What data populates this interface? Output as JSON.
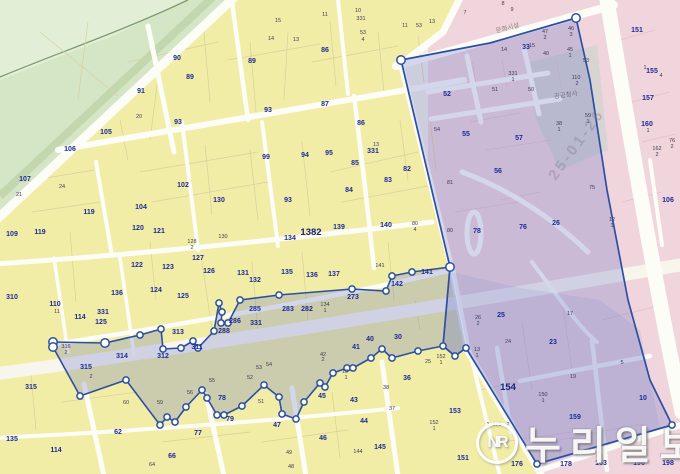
{
  "news_watermark": {
    "logo": "NR",
    "name": "누리일보"
  },
  "date_watermark": "25-01-26",
  "map": {
    "road_label": "문화시설",
    "building_label": "공공청사",
    "colors": {
      "base": "#f2efe6",
      "green": "#d5e6c6",
      "green_light": "#e3eed7",
      "green_band": "#c3d7ae",
      "green_line": "#7d9b70",
      "yellow": "#f1eda7",
      "yellow_line": "#d9cf9b",
      "pink": "#f1d5dc",
      "pink_line": "#e3bfca",
      "grey_block": "#d7d4d2",
      "road": "#fdfdf8",
      "road_major": "#f7f5ec",
      "district_overlay": "rgba(96,108,196,0.26)",
      "district_overlay2": "rgba(110,120,200,0.13)",
      "boundary": "#2b4fa3",
      "vertex_fill": "#ffffff",
      "label_main": "#1c2b96",
      "label_small": "#3d3d55"
    },
    "boundary": {
      "north": [
        [
          53,
          342
        ],
        [
          105,
          343
        ],
        [
          140,
          335
        ],
        [
          161,
          329
        ],
        [
          163,
          349
        ],
        [
          181,
          348
        ],
        [
          193,
          341
        ],
        [
          198,
          348
        ],
        [
          214,
          331
        ],
        [
          219,
          303
        ],
        [
          222,
          312
        ],
        [
          221,
          323
        ],
        [
          228,
          323
        ],
        [
          240,
          300
        ],
        [
          279,
          295
        ],
        [
          352,
          289
        ],
        [
          386,
          291
        ],
        [
          392,
          276
        ],
        [
          412,
          272
        ],
        [
          450,
          267
        ]
      ],
      "south": [
        [
          53,
          347
        ],
        [
          80,
          396
        ],
        [
          126,
          380
        ],
        [
          160,
          425
        ],
        [
          167,
          417
        ],
        [
          175,
          422
        ],
        [
          186,
          407
        ],
        [
          202,
          390
        ],
        [
          207,
          398
        ],
        [
          217,
          415
        ],
        [
          224,
          415
        ],
        [
          242,
          406
        ],
        [
          264,
          385
        ],
        [
          279,
          397
        ],
        [
          282,
          414
        ],
        [
          296,
          419
        ],
        [
          304,
          402
        ],
        [
          320,
          383
        ],
        [
          325,
          387
        ],
        [
          333,
          373
        ],
        [
          347,
          368
        ],
        [
          353,
          368
        ],
        [
          371,
          358
        ],
        [
          382,
          349
        ],
        [
          392,
          358
        ],
        [
          418,
          351
        ],
        [
          443,
          346
        ],
        [
          455,
          356
        ],
        [
          466,
          348
        ]
      ],
      "block_ring": [
        [
          576,
          18
        ],
        [
          490,
          43
        ],
        [
          401,
          60
        ],
        [
          450,
          267
        ],
        [
          443,
          346
        ],
        [
          455,
          356
        ],
        [
          466,
          348
        ],
        [
          537,
          464
        ],
        [
          672,
          425
        ],
        [
          650,
          380
        ],
        [
          628,
          300
        ],
        [
          607,
          190
        ],
        [
          590,
          80
        ]
      ],
      "extra_vertices": [
        [
          576,
          18
        ],
        [
          401,
          60
        ],
        [
          537,
          464
        ],
        [
          672,
          425
        ]
      ],
      "big_vertices": [
        [
          53,
          342
        ],
        [
          53,
          347
        ],
        [
          105,
          343
        ],
        [
          450,
          267
        ],
        [
          576,
          18
        ],
        [
          401,
          60
        ]
      ]
    },
    "labels": [
      [
        177,
        60,
        "90",
        "b"
      ],
      [
        190,
        79,
        "89",
        "b"
      ],
      [
        252,
        63,
        "89",
        "b"
      ],
      [
        141,
        93,
        "91",
        "b"
      ],
      [
        178,
        124,
        "93",
        "b"
      ],
      [
        268,
        112,
        "93",
        "b"
      ],
      [
        266,
        159,
        "99",
        "b"
      ],
      [
        106,
        134,
        "105",
        "b"
      ],
      [
        70,
        151,
        "106",
        "b"
      ],
      [
        25,
        181,
        "107",
        "b"
      ],
      [
        12,
        236,
        "109",
        "b"
      ],
      [
        40,
        234,
        "119",
        "b"
      ],
      [
        89,
        214,
        "119",
        "b"
      ],
      [
        141,
        209,
        "104",
        "b"
      ],
      [
        183,
        187,
        "102",
        "b"
      ],
      [
        138,
        230,
        "120",
        "b"
      ],
      [
        159,
        233,
        "121",
        "b"
      ],
      [
        137,
        267,
        "122",
        "b"
      ],
      [
        168,
        269,
        "123",
        "b"
      ],
      [
        156,
        292,
        "124",
        "b"
      ],
      [
        183,
        298,
        "125",
        "b"
      ],
      [
        209,
        273,
        "126",
        "b"
      ],
      [
        198,
        260,
        "127",
        "b"
      ],
      [
        219,
        202,
        "130",
        "b"
      ],
      [
        117,
        295,
        "136",
        "b"
      ],
      [
        55,
        306,
        "110",
        "b"
      ],
      [
        80,
        319,
        "114",
        "b"
      ],
      [
        103,
        314,
        "331",
        "b"
      ],
      [
        101,
        324,
        "125",
        "b"
      ],
      [
        243,
        275,
        "131",
        "b"
      ],
      [
        255,
        282,
        "132",
        "b"
      ],
      [
        287,
        274,
        "135",
        "b"
      ],
      [
        312,
        277,
        "136",
        "b"
      ],
      [
        334,
        276,
        "137",
        "b"
      ],
      [
        329,
        155,
        "95",
        "b"
      ],
      [
        305,
        157,
        "94",
        "b"
      ],
      [
        373,
        153,
        "331",
        "b"
      ],
      [
        355,
        165,
        "85",
        "b"
      ],
      [
        349,
        192,
        "84",
        "b"
      ],
      [
        388,
        182,
        "83",
        "b"
      ],
      [
        407,
        171,
        "82",
        "b"
      ],
      [
        288,
        202,
        "93",
        "b"
      ],
      [
        339,
        229,
        "139",
        "b"
      ],
      [
        290,
        240,
        "134",
        "b"
      ],
      [
        386,
        227,
        "140",
        "b"
      ],
      [
        427,
        274,
        "141",
        "b"
      ],
      [
        397,
        286,
        "142",
        "b"
      ],
      [
        353,
        299,
        "273",
        "b"
      ],
      [
        255,
        311,
        "285",
        "b"
      ],
      [
        288,
        311,
        "283",
        "b"
      ],
      [
        307,
        311,
        "282",
        "b"
      ],
      [
        235,
        323,
        "286",
        "b"
      ],
      [
        224,
        333,
        "288",
        "b"
      ],
      [
        256,
        325,
        "331",
        "b"
      ],
      [
        197,
        349,
        "311",
        "b"
      ],
      [
        163,
        358,
        "312",
        "b"
      ],
      [
        178,
        334,
        "313",
        "b"
      ],
      [
        122,
        358,
        "314",
        "b"
      ],
      [
        86,
        369,
        "315",
        "b"
      ],
      [
        31,
        389,
        "315",
        "b"
      ],
      [
        12,
        299,
        "310",
        "b"
      ],
      [
        12,
        441,
        "135",
        "b"
      ],
      [
        56,
        452,
        "114",
        "b"
      ],
      [
        118,
        434,
        "62",
        "b"
      ],
      [
        172,
        458,
        "66",
        "b"
      ],
      [
        198,
        435,
        "77",
        "b"
      ],
      [
        222,
        400,
        "78",
        "b"
      ],
      [
        230,
        421,
        "79",
        "b"
      ],
      [
        322,
        398,
        "45",
        "b"
      ],
      [
        354,
        402,
        "43",
        "b"
      ],
      [
        364,
        423,
        "44",
        "b"
      ],
      [
        277,
        427,
        "47",
        "b"
      ],
      [
        323,
        440,
        "46",
        "b"
      ],
      [
        380,
        449,
        "145",
        "b"
      ],
      [
        370,
        341,
        "40",
        "b"
      ],
      [
        356,
        349,
        "41",
        "b"
      ],
      [
        398,
        339,
        "30",
        "b"
      ],
      [
        407,
        380,
        "36",
        "b"
      ],
      [
        455,
        413,
        "153",
        "b"
      ],
      [
        463,
        460,
        "151",
        "b"
      ],
      [
        325,
        52,
        "86",
        "b"
      ],
      [
        325,
        106,
        "87",
        "b"
      ],
      [
        361,
        125,
        "86",
        "b"
      ],
      [
        447,
        96,
        "52",
        "b"
      ],
      [
        466,
        136,
        "55",
        "b"
      ],
      [
        519,
        140,
        "57",
        "b"
      ],
      [
        498,
        173,
        "56",
        "b"
      ],
      [
        477,
        233,
        "78",
        "b"
      ],
      [
        523,
        229,
        "76",
        "b"
      ],
      [
        556,
        225,
        "26",
        "b"
      ],
      [
        501,
        317,
        "25",
        "b"
      ],
      [
        553,
        344,
        "23",
        "b"
      ],
      [
        575,
        419,
        "159",
        "b"
      ],
      [
        643,
        400,
        "10",
        "b"
      ],
      [
        637,
        32,
        "151",
        "b"
      ],
      [
        652,
        73,
        "155",
        "b"
      ],
      [
        648,
        100,
        "157",
        "b"
      ],
      [
        647,
        126,
        "160",
        "b"
      ],
      [
        668,
        202,
        "106",
        "b"
      ],
      [
        526,
        49,
        "33",
        "b"
      ],
      [
        566,
        466,
        "178",
        "b"
      ],
      [
        601,
        465,
        "163",
        "b"
      ],
      [
        639,
        465,
        "196",
        "b"
      ],
      [
        668,
        465,
        "198",
        "b"
      ],
      [
        517,
        466,
        "176",
        "b"
      ],
      [
        311,
        235,
        "1382",
        "B"
      ],
      [
        508,
        390,
        "154",
        "B"
      ],
      [
        139,
        118,
        "20",
        "s"
      ],
      [
        19,
        196,
        "21",
        "s"
      ],
      [
        62,
        188,
        "24",
        "s"
      ],
      [
        57,
        313,
        "11",
        "s"
      ],
      [
        66,
        348,
        "316",
        "s"
      ],
      [
        66,
        354,
        "2",
        "s"
      ],
      [
        91,
        378,
        "2",
        "s"
      ],
      [
        126,
        404,
        "60",
        "s"
      ],
      [
        345,
        373,
        "10",
        "s"
      ],
      [
        346,
        379,
        "1",
        "s"
      ],
      [
        323,
        356,
        "42",
        "s"
      ],
      [
        323,
        361,
        "2",
        "s"
      ],
      [
        386,
        389,
        "38",
        "s"
      ],
      [
        392,
        410,
        "37",
        "s"
      ],
      [
        428,
        363,
        "25",
        "s"
      ],
      [
        190,
        394,
        "56",
        "s"
      ],
      [
        212,
        382,
        "55",
        "s"
      ],
      [
        261,
        403,
        "51",
        "s"
      ],
      [
        250,
        379,
        "52",
        "s"
      ],
      [
        259,
        369,
        "53",
        "s"
      ],
      [
        269,
        366,
        "54",
        "s"
      ],
      [
        289,
        454,
        "49",
        "s"
      ],
      [
        291,
        468,
        "48",
        "s"
      ],
      [
        358,
        453,
        "144",
        "s"
      ],
      [
        434,
        424,
        "152",
        "s"
      ],
      [
        434,
        430,
        "1",
        "s"
      ],
      [
        441,
        358,
        "152",
        "s"
      ],
      [
        441,
        364,
        "1",
        "s"
      ],
      [
        415,
        225,
        "80",
        "s"
      ],
      [
        415,
        231,
        "4",
        "s"
      ],
      [
        376,
        146,
        "13",
        "s"
      ],
      [
        325,
        306,
        "134",
        "s"
      ],
      [
        325,
        312,
        "1",
        "s"
      ],
      [
        271,
        40,
        "14",
        "s"
      ],
      [
        296,
        41,
        "13",
        "s"
      ],
      [
        278,
        22,
        "15",
        "s"
      ],
      [
        325,
        16,
        "11",
        "s"
      ],
      [
        358,
        12,
        "10",
        "s"
      ],
      [
        361,
        20,
        "331",
        "s"
      ],
      [
        363,
        34,
        "53",
        "s"
      ],
      [
        363,
        41,
        "4",
        "s"
      ],
      [
        192,
        243,
        "128",
        "s"
      ],
      [
        192,
        249,
        "2",
        "s"
      ],
      [
        223,
        238,
        "130",
        "s"
      ],
      [
        405,
        27,
        "11",
        "s"
      ],
      [
        419,
        27,
        "53",
        "s"
      ],
      [
        432,
        23,
        "13",
        "s"
      ],
      [
        465,
        14,
        "7",
        "s"
      ],
      [
        503,
        5,
        "8",
        "s"
      ],
      [
        512,
        11,
        "9",
        "s"
      ],
      [
        152,
        466,
        "64",
        "s"
      ],
      [
        160,
        404,
        "59",
        "s"
      ],
      [
        504,
        51,
        "14",
        "s"
      ],
      [
        532,
        47,
        "15",
        "s"
      ],
      [
        545,
        33,
        "47",
        "s"
      ],
      [
        545,
        39,
        "2",
        "s"
      ],
      [
        571,
        30,
        "46",
        "s"
      ],
      [
        571,
        36,
        "3",
        "s"
      ],
      [
        546,
        55,
        "40",
        "s"
      ],
      [
        570,
        51,
        "45",
        "s"
      ],
      [
        570,
        57,
        "1",
        "s"
      ],
      [
        513,
        75,
        "331",
        "s"
      ],
      [
        513,
        81,
        "1",
        "s"
      ],
      [
        495,
        91,
        "51",
        "s"
      ],
      [
        531,
        91,
        "50",
        "s"
      ],
      [
        576,
        79,
        "110",
        "s"
      ],
      [
        577,
        85,
        "2",
        "s"
      ],
      [
        559,
        125,
        "38",
        "s"
      ],
      [
        559,
        131,
        "1",
        "s"
      ],
      [
        588,
        117,
        "59",
        "s"
      ],
      [
        588,
        123,
        "1",
        "s"
      ],
      [
        437,
        131,
        "54",
        "s"
      ],
      [
        450,
        184,
        "81",
        "s"
      ],
      [
        450,
        232,
        "80",
        "s"
      ],
      [
        592,
        189,
        "75",
        "s"
      ],
      [
        612,
        221,
        "12",
        "s"
      ],
      [
        612,
        227,
        "1",
        "s"
      ],
      [
        478,
        319,
        "26",
        "s"
      ],
      [
        478,
        325,
        "2",
        "s"
      ],
      [
        508,
        343,
        "24",
        "s"
      ],
      [
        570,
        315,
        "17",
        "s"
      ],
      [
        573,
        378,
        "19",
        "s"
      ],
      [
        543,
        396,
        "150",
        "s"
      ],
      [
        543,
        402,
        "1",
        "s"
      ],
      [
        497,
        426,
        "170",
        "s"
      ],
      [
        488,
        426,
        "1",
        "s"
      ],
      [
        508,
        426,
        "2",
        "s"
      ],
      [
        477,
        351,
        "13",
        "s"
      ],
      [
        477,
        357,
        "1",
        "s"
      ],
      [
        622,
        364,
        "5",
        "s"
      ],
      [
        586,
        62,
        "53",
        "s"
      ],
      [
        645,
        69,
        "1",
        "s"
      ],
      [
        661,
        77,
        "4",
        "s"
      ],
      [
        648,
        132,
        "1",
        "s"
      ],
      [
        657,
        150,
        "162",
        "s"
      ],
      [
        657,
        156,
        "2",
        "s"
      ],
      [
        672,
        142,
        "76",
        "s"
      ],
      [
        672,
        148,
        "2",
        "s"
      ],
      [
        380,
        267,
        "141",
        "s"
      ]
    ]
  }
}
